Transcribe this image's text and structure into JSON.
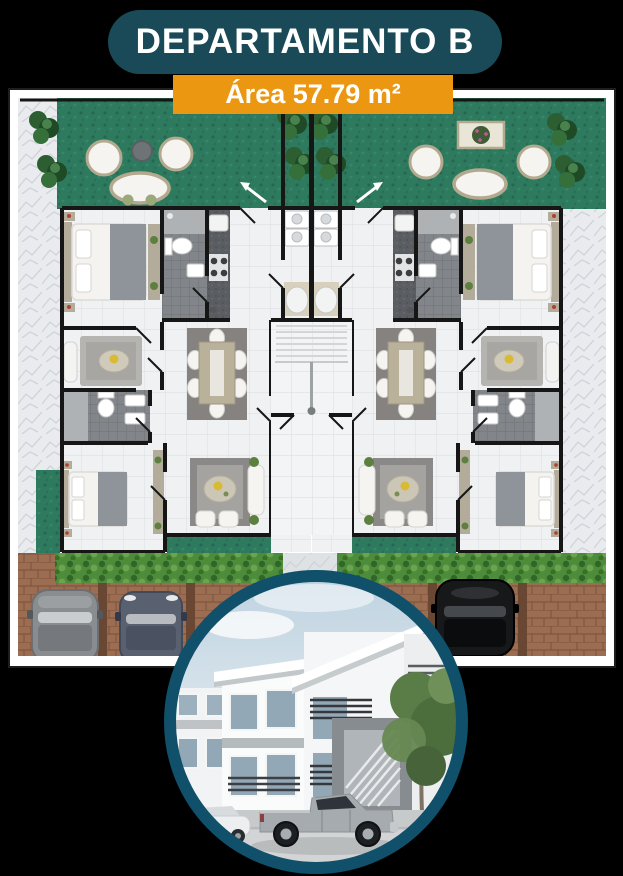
{
  "header": {
    "title": "DEPARTAMENTO B",
    "area_label": "Área 57.79 m²"
  },
  "colors": {
    "background": "#000000",
    "badge_bg": "#1a4a57",
    "badge_text": "#ffffff",
    "banner_bg": "#ec9711",
    "banner_text": "#ffffff",
    "photo_ring": "#11506a",
    "garden_green": "#2e7a5f",
    "hedge_green": "#4c8c3b",
    "parking_brown": "#9c6d50",
    "divider_brown": "#6a4733",
    "wall_black": "#161616",
    "marble_gray": "#e9ebee",
    "floor_tile": "#eff1f2",
    "bath_tile": "#82868a",
    "counter_gray": "#5a5e62",
    "furniture_white": "#f5f4f1",
    "wicker_tan": "#b2a98e",
    "sky_blue": "#bdd2e0"
  }
}
